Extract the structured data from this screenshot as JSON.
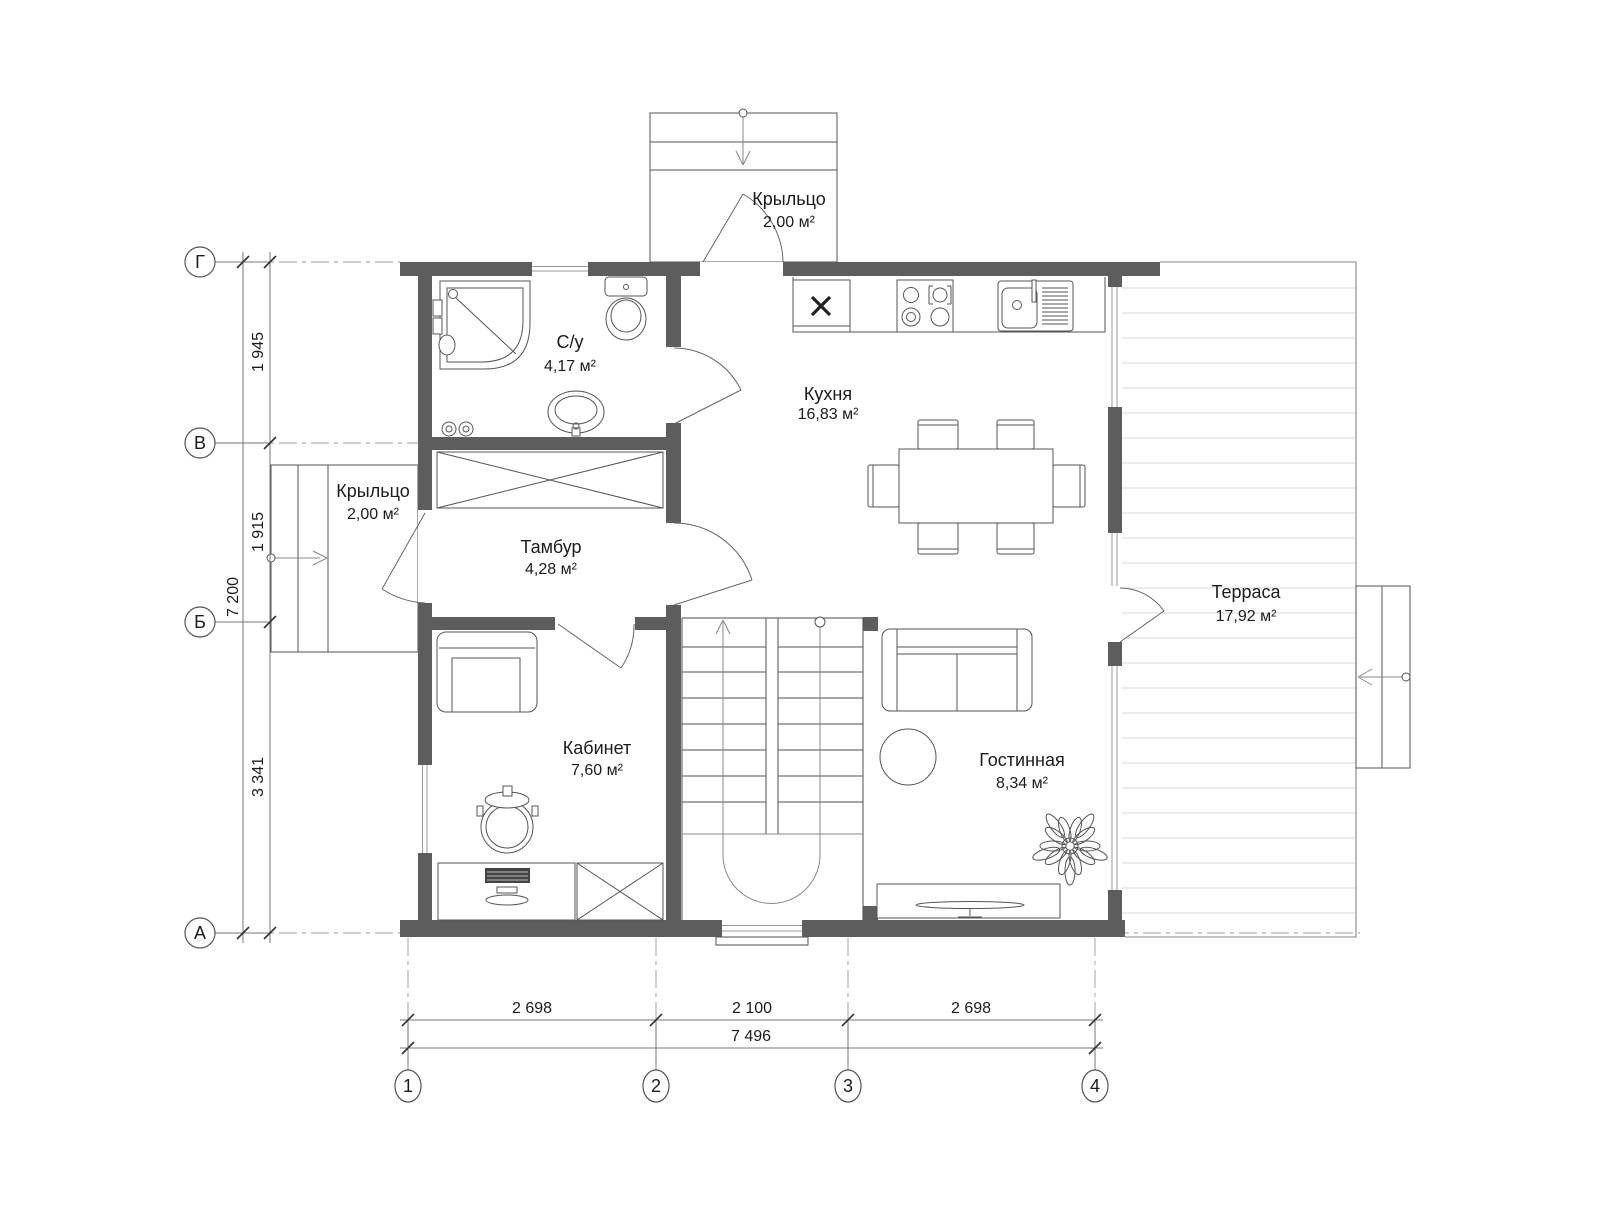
{
  "rooms": [
    {
      "id": "porch-top",
      "name": "Крыльцо",
      "area": "2,00 м²"
    },
    {
      "id": "bathroom",
      "name": "С/у",
      "area": "4,17 м²"
    },
    {
      "id": "kitchen",
      "name": "Кухня",
      "area": "16,83 м²"
    },
    {
      "id": "porch-left",
      "name": "Крыльцо",
      "area": "2,00 м²"
    },
    {
      "id": "vestibule",
      "name": "Тамбур",
      "area": "4,28 м²"
    },
    {
      "id": "office",
      "name": "Кабинет",
      "area": "7,60 м²"
    },
    {
      "id": "living-room",
      "name": "Гостинная",
      "area": "8,34 м²"
    },
    {
      "id": "terrace",
      "name": "Терраса",
      "area": "17,92 м²"
    }
  ],
  "axes": {
    "rows": [
      {
        "label": "Г"
      },
      {
        "label": "В"
      },
      {
        "label": "Б"
      },
      {
        "label": "А"
      }
    ],
    "cols": [
      {
        "label": "1"
      },
      {
        "label": "2"
      },
      {
        "label": "3"
      },
      {
        "label": "4"
      }
    ]
  },
  "dimensions": {
    "left_segments": [
      {
        "value": "1 945"
      },
      {
        "value": "1 915"
      },
      {
        "value": "3 341"
      }
    ],
    "left_total": "7 200",
    "bottom_segments": [
      {
        "value": "2 698"
      },
      {
        "value": "2 100"
      },
      {
        "value": "2 698"
      }
    ],
    "bottom_total": "7 496"
  },
  "colors": {
    "wall": "#5d5d5d",
    "line": "#4f4f4f",
    "furn": "#555555",
    "dim": "#777777",
    "axis": "#999999",
    "deck": "#d9d9d9",
    "text": "#1b1b1b",
    "bg": "#ffffff"
  }
}
